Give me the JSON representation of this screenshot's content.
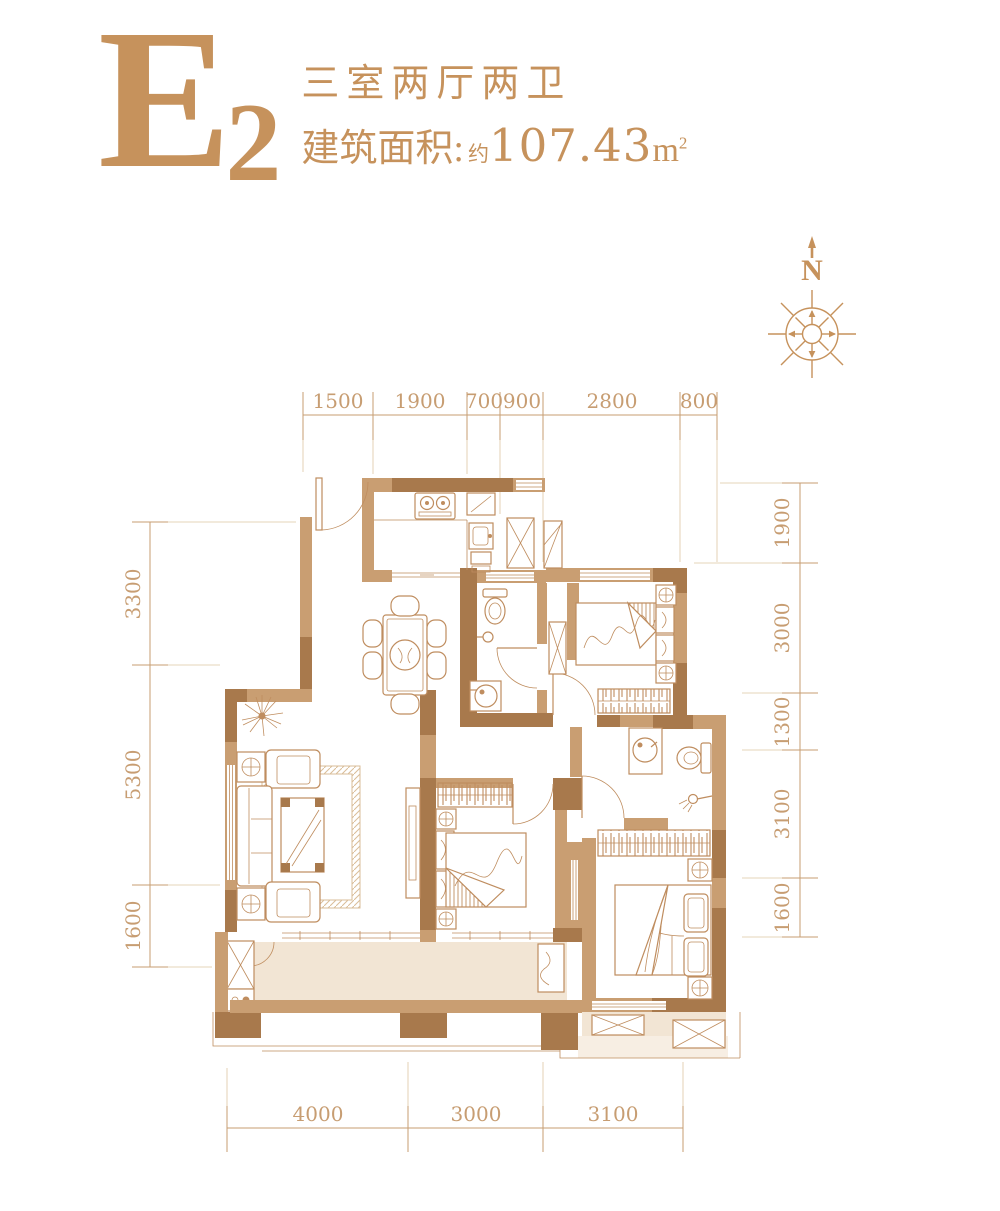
{
  "header": {
    "plan_code_letter": "E",
    "plan_code_number": "2",
    "layout_desc": "三室两厅两卫",
    "area_label": "建筑面积:",
    "area_approx": "约",
    "area_value": "107.43",
    "area_unit_base": "m",
    "area_unit_sup": "2"
  },
  "compass": {
    "north_label": "N"
  },
  "dimensions": {
    "top": [
      "1500",
      "1900",
      "700",
      "900",
      "2800",
      "800"
    ],
    "left": [
      "3300",
      "5300",
      "1600"
    ],
    "right": [
      "1900",
      "3000",
      "1300",
      "3100",
      "1600"
    ],
    "bottom": [
      "4000",
      "3000",
      "3100"
    ]
  },
  "colors": {
    "accent": "#c6925c",
    "wall_dark": "#a8794c",
    "wall_light": "#c99e72",
    "line": "#bf8d5f",
    "line_soft": "#d9bd98",
    "dim_text": "#c79d72",
    "floor": "#f2e5d4",
    "ext_line": "#ddc6a3"
  }
}
